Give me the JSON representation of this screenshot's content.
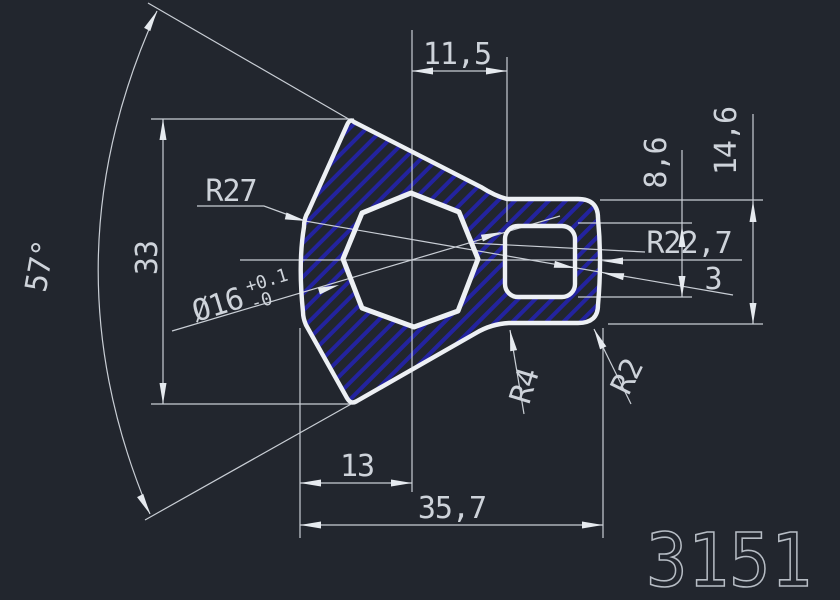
{
  "drawing": {
    "part_number": "3151",
    "dims": {
      "top_width": "11,5",
      "angle": "57°",
      "height": "33",
      "left_radius": "R27",
      "bore_dia": "Ø16",
      "bore_tol_upper": "+0.1",
      "bore_tol_lower": "-0",
      "slot_height": "8,6",
      "lobe_height": "14,6",
      "right_radius": "R22,7",
      "wall_thickness": "3",
      "neck_fillet": "R4",
      "corner_radius": "R2",
      "center_to_left": "13",
      "overall_width": "35,7"
    },
    "colors": {
      "background": "#22262e",
      "outline": "#edf0f4",
      "dimension": "#c9ced5",
      "hatch_blue": "#23239f",
      "part_number_gray": "#b7bdc5"
    }
  }
}
